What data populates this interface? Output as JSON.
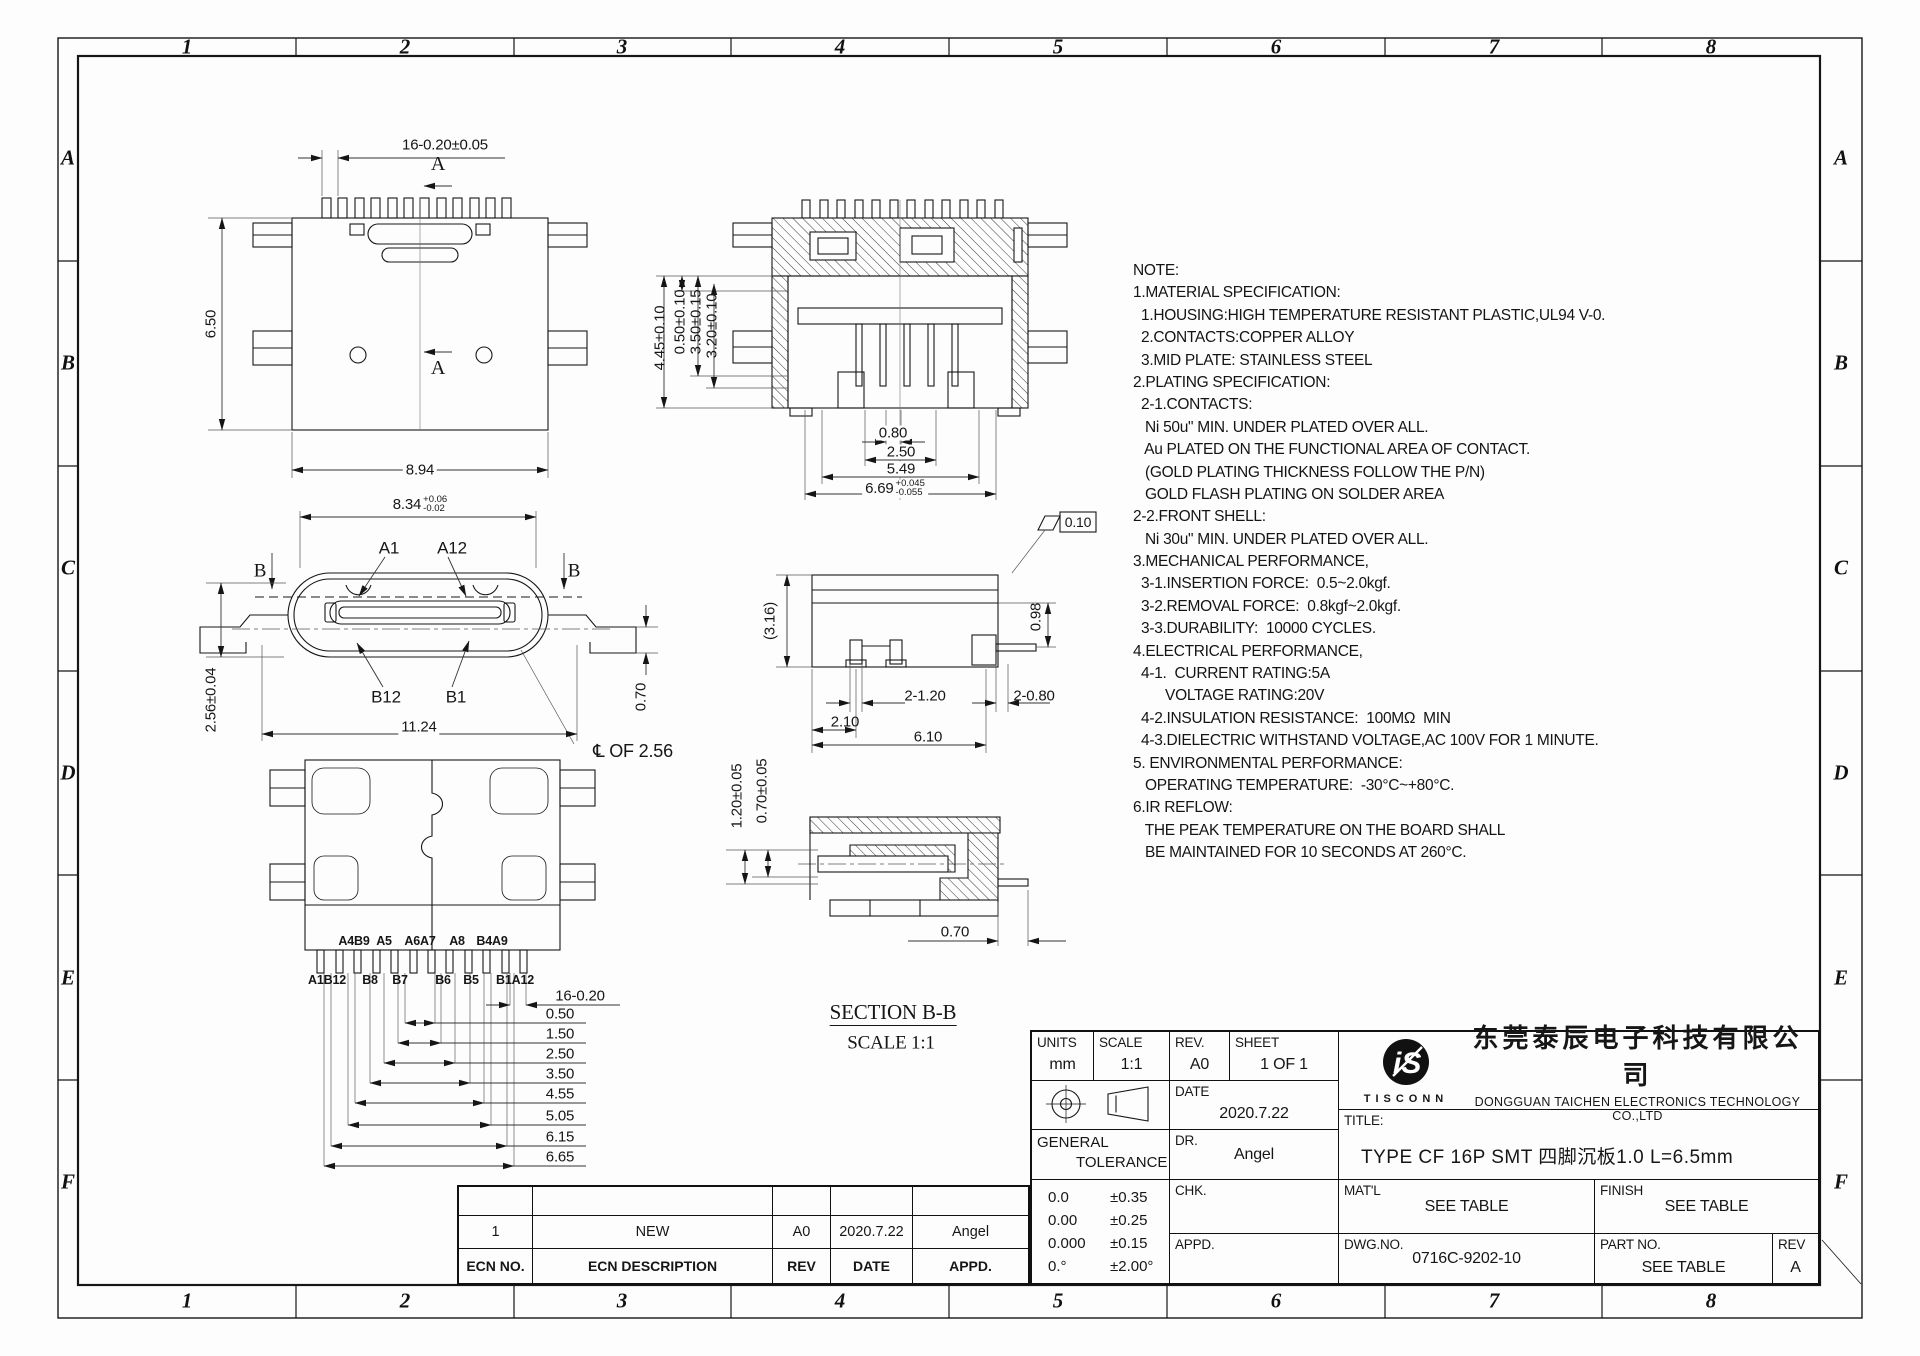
{
  "sheet": {
    "zone_cols": [
      "1",
      "2",
      "3",
      "4",
      "5",
      "6",
      "7",
      "8"
    ],
    "zone_rows": [
      "A",
      "B",
      "C",
      "D",
      "E",
      "F"
    ],
    "line_color": "#161616",
    "background": "#fdfdfd"
  },
  "notes": {
    "lines": [
      "NOTE:",
      "1.MATERIAL SPECIFICATION:",
      "  1.HOUSING:HIGH TEMPERATURE RESISTANT PLASTIC,UL94 V-0.",
      "  2.CONTACTS:COPPER ALLOY",
      "  3.MID PLATE: STAINLESS STEEL",
      "2.PLATING SPECIFICATION:",
      "  2-1.CONTACTS:",
      "   Ni 50u\" MIN. UNDER PLATED OVER ALL.",
      "   Au PLATED ON THE FUNCTIONAL AREA OF CONTACT.",
      "   (GOLD PLATING THICKNESS FOLLOW THE P/N)",
      "   GOLD FLASH PLATING ON SOLDER AREA",
      "2-2.FRONT SHELL:",
      "   Ni 30u\" MIN. UNDER PLATED OVER ALL.",
      "3.MECHANICAL PERFORMANCE,",
      "  3-1.INSERTION FORCE:  0.5~2.0kgf.",
      "  3-2.REMOVAL FORCE:  0.8kgf~2.0kgf.",
      "  3-3.DURABILITY:  10000 CYCLES.",
      "4.ELECTRICAL PERFORMANCE,",
      "  4-1.  CURRENT RATING:5A",
      "        VOLTAGE RATING:20V",
      "  4-2.INSULATION RESISTANCE:  100MΩ  MIN",
      "  4-3.DIELECTRIC WITHSTAND VOLTAGE,AC 100V FOR 1 MINUTE.",
      "5. ENVIRONMENTAL PERFORMANCE:",
      "   OPERATING TEMPERATURE:  -30°C~+80°C.",
      "6.IR REFLOW:",
      "   THE PEAK TEMPERATURE ON THE BOARD SHALL",
      "   BE MAINTAINED FOR 10 SECONDS AT 260°C."
    ]
  },
  "labels": [
    {
      "name": "dim-tooth-pitch",
      "text": "16-0.20±0.05",
      "x": 445,
      "y": 145
    },
    {
      "name": "section-a-label-top",
      "text": "A",
      "x": 438,
      "y": 164,
      "fs": 20,
      "cls": "serif"
    },
    {
      "name": "section-a-label-bottom",
      "text": "A",
      "x": 438,
      "y": 368,
      "fs": 20,
      "cls": "serif"
    },
    {
      "name": "dim-body-height",
      "text": "6.50",
      "x": 211,
      "y": 324,
      "rot": 1
    },
    {
      "name": "dim-body-width",
      "text": "8.94",
      "x": 420,
      "y": 470,
      "bg": 1
    },
    {
      "name": "dim-shell-height",
      "text": "4.45±0.10",
      "x": 660,
      "y": 338,
      "rot": 1
    },
    {
      "name": "dim",
      "text": "0.50±0.10",
      "x": 680,
      "y": 322,
      "rot": 1
    },
    {
      "name": "dim",
      "text": "3.50±0.15",
      "x": 696,
      "y": 322,
      "rot": 1
    },
    {
      "name": "dim",
      "text": "3.20±0.10",
      "x": 712,
      "y": 326,
      "rot": 1
    },
    {
      "name": "dim",
      "text": "0.80",
      "x": 893,
      "y": 433,
      "bg": 1
    },
    {
      "name": "dim",
      "text": "2.50",
      "x": 901,
      "y": 452,
      "bg": 1
    },
    {
      "name": "dim",
      "text": "5.49",
      "x": 901,
      "y": 469,
      "bg": 1
    },
    {
      "name": "dim",
      "text": "6.69",
      "sup": "+0.045",
      "sub": "-0.055",
      "x": 895,
      "y": 489,
      "bg": 1
    },
    {
      "name": "dim-tongue-width",
      "text": "8.34",
      "sup": "+0.06",
      "sub": "-0.02",
      "x": 420,
      "y": 505,
      "bg": 1
    },
    {
      "name": "pin-callout-a1",
      "text": "A1",
      "x": 389,
      "y": 548,
      "fs": 17
    },
    {
      "name": "pin-callout-a12",
      "text": "A12",
      "x": 452,
      "y": 548,
      "fs": 17
    },
    {
      "name": "section-b-label-left",
      "text": "B",
      "x": 260,
      "y": 571,
      "fs": 19,
      "cls": "serif"
    },
    {
      "name": "section-b-label-right",
      "text": "B",
      "x": 574,
      "y": 571,
      "fs": 19,
      "cls": "serif"
    },
    {
      "name": "pin-callout-b12",
      "text": "B12",
      "x": 386,
      "y": 697,
      "fs": 17
    },
    {
      "name": "pin-callout-b1",
      "text": "B1",
      "x": 456,
      "y": 697,
      "fs": 17
    },
    {
      "name": "dim",
      "text": "2.56±0.04",
      "x": 211,
      "y": 700,
      "rot": 1
    },
    {
      "name": "dim",
      "text": "11.24",
      "x": 419,
      "y": 727,
      "bg": 1
    },
    {
      "name": "dim",
      "text": "0.70",
      "x": 641,
      "y": 697,
      "rot": 1
    },
    {
      "name": "centerline-note",
      "text": "℄ OF 2.56",
      "x": 633,
      "y": 751,
      "fs": 18
    },
    {
      "name": "dim",
      "text": "(3.16)",
      "x": 770,
      "y": 621,
      "rot": 1
    },
    {
      "name": "dim",
      "text": "0.98",
      "x": 1036,
      "y": 617,
      "rot": 1
    },
    {
      "name": "dim",
      "text": "2-1.20",
      "x": 925,
      "y": 696
    },
    {
      "name": "dim",
      "text": "2-0.80",
      "x": 1034,
      "y": 696
    },
    {
      "name": "dim",
      "text": "2.10",
      "x": 845,
      "y": 722
    },
    {
      "name": "dim",
      "text": "6.10",
      "x": 928,
      "y": 737
    },
    {
      "name": "flatness-tolerance",
      "text": "0.10",
      "x": 1078,
      "y": 522,
      "fs": 14
    },
    {
      "name": "pin-label",
      "text": "A4B9",
      "x": 354,
      "y": 941,
      "fs": 12.5,
      "bold": 1
    },
    {
      "name": "pin-label",
      "text": "A5",
      "x": 384,
      "y": 941,
      "fs": 12.5,
      "bold": 1
    },
    {
      "name": "pin-label",
      "text": "A6A7",
      "x": 420,
      "y": 941,
      "fs": 12.5,
      "bold": 1
    },
    {
      "name": "pin-label",
      "text": "A8",
      "x": 457,
      "y": 941,
      "fs": 12.5,
      "bold": 1
    },
    {
      "name": "pin-label",
      "text": "B4A9",
      "x": 492,
      "y": 941,
      "fs": 12.5,
      "bold": 1
    },
    {
      "name": "pin-label",
      "text": "A1B12",
      "x": 327,
      "y": 980,
      "fs": 12.5,
      "bold": 1
    },
    {
      "name": "pin-label",
      "text": "B8",
      "x": 370,
      "y": 980,
      "fs": 12.5,
      "bold": 1
    },
    {
      "name": "pin-label",
      "text": "B7",
      "x": 400,
      "y": 980,
      "fs": 12.5,
      "bold": 1
    },
    {
      "name": "pin-label",
      "text": "B6",
      "x": 443,
      "y": 980,
      "fs": 12.5,
      "bold": 1
    },
    {
      "name": "pin-label",
      "text": "B5",
      "x": 471,
      "y": 980,
      "fs": 12.5,
      "bold": 1
    },
    {
      "name": "pin-label",
      "text": "B1A12",
      "x": 515,
      "y": 980,
      "fs": 12.5,
      "bold": 1
    },
    {
      "name": "dim",
      "text": "16-0.20",
      "x": 580,
      "y": 996
    },
    {
      "name": "dim",
      "text": "0.50",
      "x": 560,
      "y": 1014
    },
    {
      "name": "dim",
      "text": "1.50",
      "x": 560,
      "y": 1034
    },
    {
      "name": "dim",
      "text": "2.50",
      "x": 560,
      "y": 1054
    },
    {
      "name": "dim",
      "text": "3.50",
      "x": 560,
      "y": 1074
    },
    {
      "name": "dim",
      "text": "4.55",
      "x": 560,
      "y": 1094
    },
    {
      "name": "dim",
      "text": "5.05",
      "x": 560,
      "y": 1116
    },
    {
      "name": "dim",
      "text": "6.15",
      "x": 560,
      "y": 1137
    },
    {
      "name": "dim",
      "text": "6.65",
      "x": 560,
      "y": 1157
    },
    {
      "name": "dim",
      "text": "1.20±0.05",
      "x": 737,
      "y": 796,
      "rot": 1
    },
    {
      "name": "dim",
      "text": "0.70±0.05",
      "x": 762,
      "y": 791,
      "rot": 1
    },
    {
      "name": "dim",
      "text": "0.70",
      "x": 955,
      "y": 932
    },
    {
      "name": "section-title",
      "text": "SECTION B-B",
      "x": 893,
      "y": 1014,
      "fs": 21,
      "cls": "serif underline"
    },
    {
      "name": "section-scale",
      "text": "SCALE 1:1",
      "x": 891,
      "y": 1043,
      "fs": 19,
      "cls": "serif"
    }
  ],
  "title_block": {
    "units_label": "UNITS",
    "units_value": "mm",
    "scale_label": "SCALE",
    "scale_value": "1:1",
    "rev_label": "REV.",
    "rev_value": "A0",
    "sheet_label": "SHEET",
    "sheet_value": "1 OF 1",
    "date_label": "DATE",
    "date_value": "2020.7.22",
    "general_tolerance_label_1": "GENERAL",
    "general_tolerance_label_2": "TOLERANCE",
    "dr_label": "DR.",
    "dr_value": "Angel",
    "tolerances": [
      [
        "0.0",
        "±0.35"
      ],
      [
        "0.00",
        "±0.25"
      ],
      [
        "0.000",
        "±0.15"
      ],
      [
        "0.°",
        "±2.00°"
      ]
    ],
    "chk_label": "CHK.",
    "chk_value": "",
    "appd_label": "APPD.",
    "appd_value": "",
    "matl_label": "MAT'L",
    "matl_value": "SEE TABLE",
    "finish_label": "FINISH",
    "finish_value": "SEE TABLE",
    "dwg_no_label": "DWG.NO.",
    "dwg_no_value": "0716C-9202-10",
    "part_no_label": "PART NO.",
    "part_no_value": "SEE TABLE",
    "rev2_label": "REV",
    "rev2_value": "A",
    "title_label": "TITLE:",
    "title_value": "TYPE CF 16P SMT 四脚沉板1.0 L=6.5mm",
    "company_cn": "东莞泰辰电子科技有限公司",
    "company_en": "DONGGUAN TAICHEN ELECTRONICS TECHNOLOGY CO.,LTD",
    "logo_text": "TISCONN",
    "logo_monogram": "iS"
  },
  "ecn_table": {
    "headers": [
      "ECN NO.",
      "ECN DESCRIPTION",
      "REV",
      "DATE",
      "APPD."
    ],
    "rows": [
      [
        "",
        "",
        "",
        "",
        ""
      ],
      [
        "1",
        "NEW",
        "A0",
        "2020.7.22",
        "Angel"
      ]
    ]
  }
}
